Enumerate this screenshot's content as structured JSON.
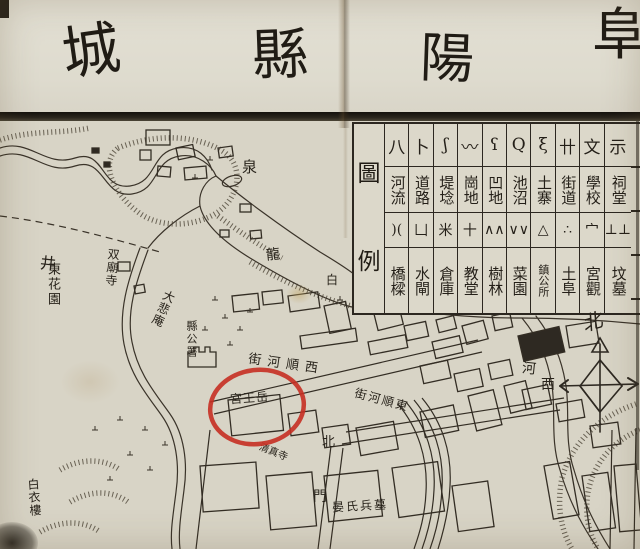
{
  "colors": {
    "paper": "#d8d4c6",
    "ink": "#2e2922",
    "title_rule": "#191611",
    "annotation_red": "#c62f22"
  },
  "title": {
    "display_chars": [
      "城",
      "縣",
      "陽",
      "阜"
    ],
    "reading_order": "right-to-left"
  },
  "legend": {
    "title_chars": [
      "圖",
      "例"
    ],
    "columns": [
      {
        "id": "river",
        "sym_top": "八",
        "top": "河流",
        "sym_bot": ")(",
        "bot": "橋樑"
      },
      {
        "id": "road",
        "sym_top": "卜",
        "top": "道路",
        "sym_bot": "凵",
        "bot": "水閘"
      },
      {
        "id": "dike",
        "sym_top": "ʃ",
        "top": "堤埝",
        "sym_bot": "米",
        "bot": "倉庫"
      },
      {
        "id": "hill",
        "sym_top": "〰",
        "top": "崗地",
        "sym_bot": "十",
        "bot": "教堂"
      },
      {
        "id": "lowland",
        "sym_top": "ʕ",
        "top": "凹地",
        "sym_bot": "∧∧",
        "bot": "樹林"
      },
      {
        "id": "pond",
        "sym_top": "Q",
        "top": "池沼",
        "sym_bot": "∨∨",
        "bot": "菜園"
      },
      {
        "id": "fort",
        "sym_top": "ξ",
        "top": "土寨",
        "sym_bot": "△",
        "bot": "鎮公所"
      },
      {
        "id": "street",
        "sym_top": "卄",
        "top": "街道",
        "sym_bot": "∴",
        "bot": "土阜"
      },
      {
        "id": "school",
        "sym_top": "文",
        "top": "學校",
        "sym_bot": "宀",
        "bot": "宮觀"
      },
      {
        "id": "shrine",
        "sym_top": "示",
        "top": "祠堂",
        "sym_bot": "⊥⊥",
        "bot": "坟墓"
      }
    ]
  },
  "map_labels": [
    {
      "id": "spring",
      "text": "泉",
      "x": 242,
      "y": 160,
      "size": 15,
      "rot": 0,
      "v": false,
      "ls": 0
    },
    {
      "id": "well",
      "text": "井",
      "x": 40,
      "y": 256,
      "size": 16,
      "rot": 6,
      "v": false,
      "ls": 0
    },
    {
      "id": "east-garden",
      "text": "東花園",
      "x": 46,
      "y": 262,
      "size": 13,
      "rot": 0,
      "v": true,
      "ls": 2
    },
    {
      "id": "twin-temple",
      "text": "双廟寺",
      "x": 106,
      "y": 248,
      "size": 12,
      "rot": 5,
      "v": true,
      "ls": 1
    },
    {
      "id": "dabei-nunnery",
      "text": "大悲庵",
      "x": 157,
      "y": 289,
      "size": 12,
      "rot": 24,
      "v": true,
      "ls": 1
    },
    {
      "id": "county-office",
      "text": "縣公署",
      "x": 186,
      "y": 320,
      "size": 11,
      "rot": 0,
      "v": true,
      "ls": 0
    },
    {
      "id": "dragon",
      "text": "龍",
      "x": 266,
      "y": 248,
      "size": 14,
      "rot": -6,
      "v": false,
      "ls": 0
    },
    {
      "id": "white",
      "text": "白",
      "x": 326,
      "y": 274,
      "size": 12,
      "rot": 0,
      "v": false,
      "ls": 0
    },
    {
      "id": "west-shunhe-street",
      "text": "街河順西",
      "x": 248,
      "y": 358,
      "size": 13,
      "rot": 8,
      "v": false,
      "ls": 6
    },
    {
      "id": "east-shunhe-street",
      "text": "街河順東",
      "x": 354,
      "y": 394,
      "size": 12,
      "rot": 15,
      "v": false,
      "ls": 2
    },
    {
      "id": "yuewang-palace",
      "text": "宮王岳",
      "x": 230,
      "y": 392,
      "size": 12,
      "rot": -4,
      "v": false,
      "ls": 1
    },
    {
      "id": "north-gate-north",
      "text": "北",
      "x": 322,
      "y": 436,
      "size": 13,
      "rot": 0,
      "v": false,
      "ls": 0
    },
    {
      "id": "north-gate-gate",
      "text": "門",
      "x": 313,
      "y": 490,
      "size": 14,
      "rot": 0,
      "v": false,
      "ls": 0
    },
    {
      "id": "yan-tombs",
      "text": "晏氏兵墓",
      "x": 332,
      "y": 500,
      "size": 12,
      "rot": -3,
      "v": false,
      "ls": 2
    },
    {
      "id": "mosque",
      "text": "清真寺",
      "x": 258,
      "y": 448,
      "size": 10,
      "rot": 22,
      "v": false,
      "ls": 0
    },
    {
      "id": "baiyi-tower",
      "text": "白衣樓",
      "x": 28,
      "y": 478,
      "size": 12,
      "rot": -4,
      "v": true,
      "ls": 1
    },
    {
      "id": "river",
      "text": "河",
      "x": 522,
      "y": 362,
      "size": 14,
      "rot": 6,
      "v": false,
      "ls": 0
    }
  ],
  "compass": {
    "north": "北",
    "west": "西"
  },
  "annotation_circle": {
    "color": "#c62f22",
    "circled_label": "宮王岳"
  }
}
